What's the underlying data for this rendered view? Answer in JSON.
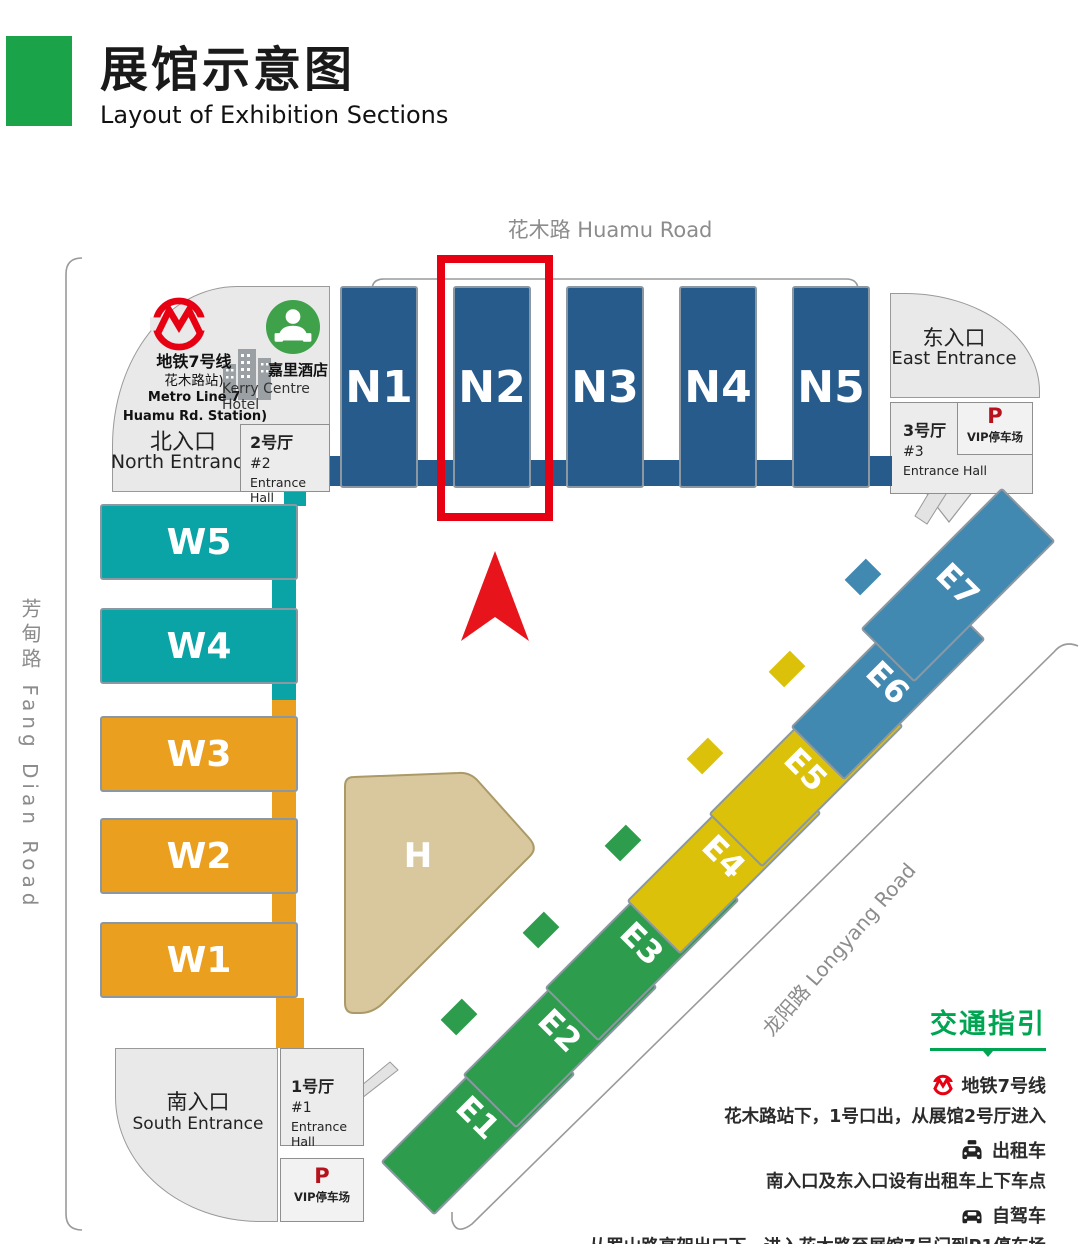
{
  "header": {
    "title_zh": "展馆示意图",
    "title_en": "Layout of Exhibition Sections",
    "accent_color": "#1aa348"
  },
  "roads": {
    "top": "花木路 Huamu Road",
    "left": "芳甸路 Fang Dian Road",
    "diagonal": "龙阳路 Longyang Road"
  },
  "landmarks": {
    "metro_station": {
      "line1": "地铁7号线",
      "line2": "花木路站)",
      "line3": "Metro Line 7",
      "line4": "Huamu Rd. Station)"
    },
    "hotel": {
      "zh": "嘉里酒店",
      "en": "Kerry Centre Hotel"
    }
  },
  "entrances": {
    "north": {
      "zh": "北入口",
      "en": "North Entrance"
    },
    "east": {
      "zh": "东入口",
      "en": "East Entrance"
    },
    "south": {
      "zh": "南入口",
      "en": "South Entrance"
    }
  },
  "entrance_halls": {
    "hall1": {
      "zh": "1号厅",
      "num": "#1",
      "en": "Entrance Hall"
    },
    "hall2": {
      "zh": "2号厅",
      "num": "#2",
      "en": "Entrance Hall"
    },
    "hall3": {
      "zh": "3号厅",
      "num": "#3",
      "en": "Entrance Hall"
    }
  },
  "parking": {
    "p": "P",
    "vip": "VIP停车场"
  },
  "halls": {
    "north": [
      {
        "id": "N1",
        "color": "#275b8c"
      },
      {
        "id": "N2",
        "color": "#275b8c"
      },
      {
        "id": "N3",
        "color": "#275b8c"
      },
      {
        "id": "N4",
        "color": "#275b8c"
      },
      {
        "id": "N5",
        "color": "#275b8c"
      }
    ],
    "west": [
      {
        "id": "W5",
        "color": "#0aa3a6"
      },
      {
        "id": "W4",
        "color": "#0aa3a6"
      },
      {
        "id": "W3",
        "color": "#ea9f1f"
      },
      {
        "id": "W2",
        "color": "#ea9f1f"
      },
      {
        "id": "W1",
        "color": "#ea9f1f"
      }
    ],
    "east": [
      {
        "id": "E1",
        "color": "#2e9c4d"
      },
      {
        "id": "E2",
        "color": "#2e9c4d"
      },
      {
        "id": "E3",
        "color": "#2e9c4d"
      },
      {
        "id": "E4",
        "color": "#dcc10a"
      },
      {
        "id": "E5",
        "color": "#dcc10a"
      },
      {
        "id": "E6",
        "color": "#4289b2"
      },
      {
        "id": "E7",
        "color": "#4289b2"
      }
    ],
    "h": {
      "id": "H",
      "color": "#d9c89e"
    }
  },
  "highlight": {
    "hall": "N2",
    "color": "#e60012"
  },
  "guide": {
    "title": "交通指引",
    "metro": {
      "heading": "地铁7号线",
      "text": "花木路站下，1号口出，从展馆2号厅进入"
    },
    "taxi": {
      "heading": "出租车",
      "text": "南入口及东入口设有出租车上下车点"
    },
    "drive": {
      "heading": "自驾车",
      "text": "从罗山路高架出口下，进入花木路至展馆7号门到P1停车场"
    }
  }
}
